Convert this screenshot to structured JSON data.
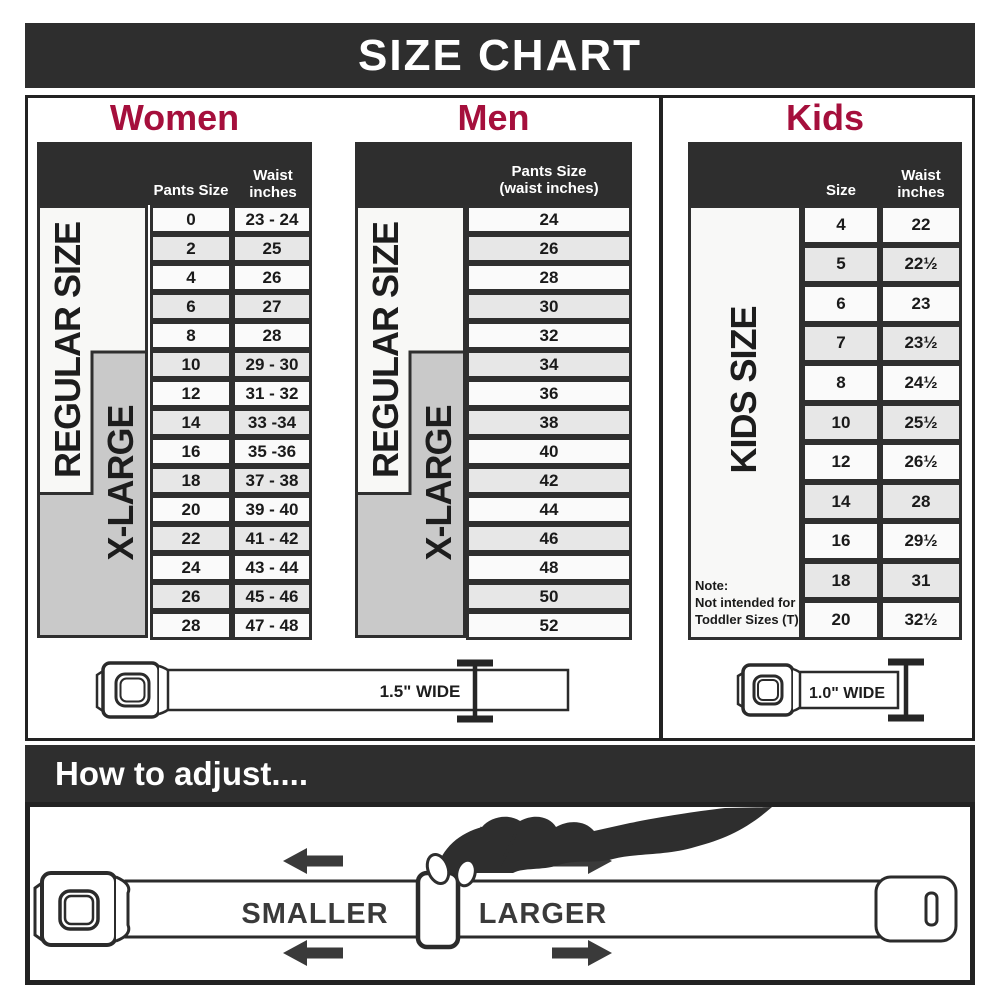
{
  "header": {
    "title": "SIZE CHART"
  },
  "colors": {
    "accent_red": "#A50F3C",
    "bar_dark": "#2E2E2E",
    "row_alt_gray": "#E7E7E7",
    "xlarge_gray": "#C9C9C9"
  },
  "women": {
    "title": "Women",
    "header": {
      "col1": "Pants Size",
      "col2": "Waist\ninches"
    },
    "regular_label": "REGULAR SIZE",
    "xlarge_label": "X-LARGE",
    "rows": [
      {
        "size": "0",
        "waist": "23 - 24"
      },
      {
        "size": "2",
        "waist": "25"
      },
      {
        "size": "4",
        "waist": "26"
      },
      {
        "size": "6",
        "waist": "27"
      },
      {
        "size": "8",
        "waist": "28"
      },
      {
        "size": "10",
        "waist": "29 - 30"
      },
      {
        "size": "12",
        "waist": "31 - 32"
      },
      {
        "size": "14",
        "waist": "33 -34"
      },
      {
        "size": "16",
        "waist": "35 -36"
      },
      {
        "size": "18",
        "waist": "37 - 38"
      },
      {
        "size": "20",
        "waist": "39 - 40"
      },
      {
        "size": "22",
        "waist": "41 - 42"
      },
      {
        "size": "24",
        "waist": "43 - 44"
      },
      {
        "size": "26",
        "waist": "45 - 46"
      },
      {
        "size": "28",
        "waist": "47 - 48"
      }
    ]
  },
  "men": {
    "title": "Men",
    "header": "Pants Size\n(waist inches)",
    "regular_label": "REGULAR SIZE",
    "xlarge_label": "X-LARGE",
    "rows": [
      "24",
      "26",
      "28",
      "30",
      "32",
      "34",
      "36",
      "38",
      "40",
      "42",
      "44",
      "46",
      "48",
      "50",
      "52"
    ]
  },
  "kids": {
    "title": "Kids",
    "header": {
      "col1": "Size",
      "col2": "Waist\ninches"
    },
    "side_label": "KIDS SIZE",
    "note": "Note:\nNot intended for\nToddler Sizes (T)",
    "rows": [
      {
        "size": "4",
        "waist": "22"
      },
      {
        "size": "5",
        "waist": "22½"
      },
      {
        "size": "6",
        "waist": "23"
      },
      {
        "size": "7",
        "waist": "23½"
      },
      {
        "size": "8",
        "waist": "24½"
      },
      {
        "size": "10",
        "waist": "25½"
      },
      {
        "size": "12",
        "waist": "26½"
      },
      {
        "size": "14",
        "waist": "28"
      },
      {
        "size": "16",
        "waist": "29½"
      },
      {
        "size": "18",
        "waist": "31"
      },
      {
        "size": "20",
        "waist": "32½"
      }
    ]
  },
  "belts": {
    "adult_width_label": "1.5\" WIDE",
    "kids_width_label": "1.0\" WIDE"
  },
  "adjust": {
    "title": "How to adjust....",
    "smaller_label": "SMALLER",
    "larger_label": "LARGER"
  }
}
